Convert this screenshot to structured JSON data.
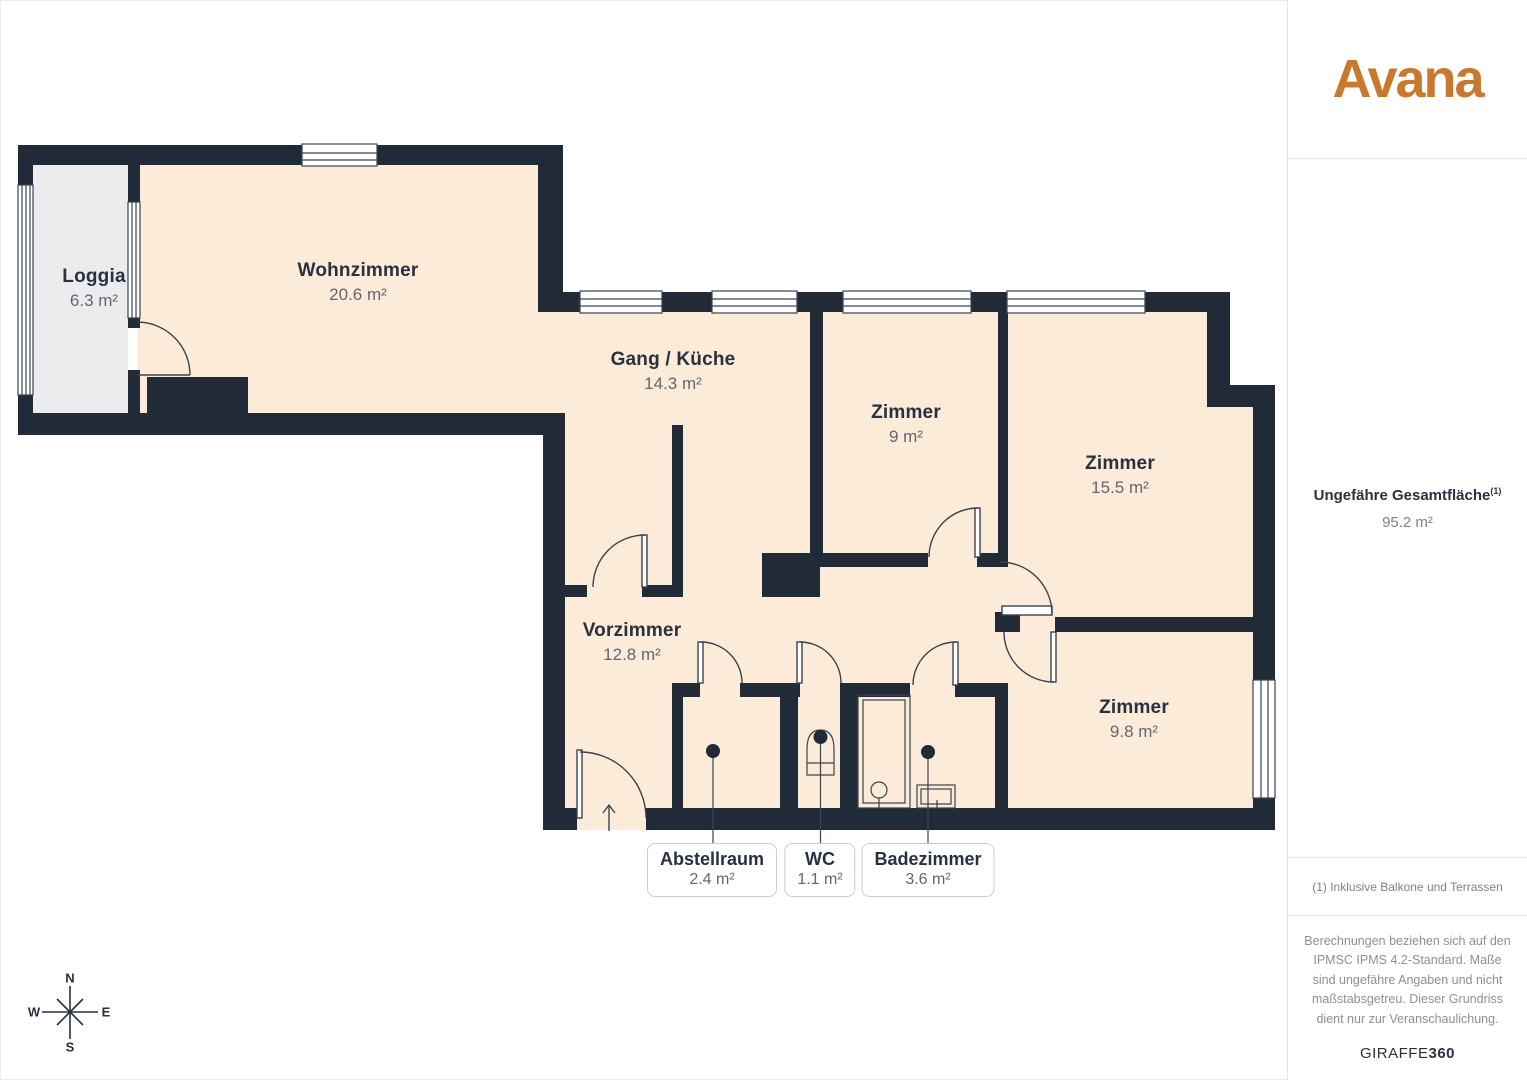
{
  "sidebar": {
    "brand": "Avana",
    "total_area_label": "Ungefähre Gesamtfläche",
    "total_area_superscript": "(1)",
    "total_area_value": "95.2 m²",
    "footnote": "(1) Inklusive Balkone und Terrassen",
    "disclaimer": "Berechnungen beziehen sich auf den IPMSC IPMS 4.2-Standard. Maße sind ungefähre Angaben und nicht maßstabsgetreu. Dieser Grundriss dient nur zur Veranschaulichung.",
    "watermark_regular": "GIRAFFE",
    "watermark_bold": "360"
  },
  "floorplan": {
    "rooms": [
      {
        "name": "Loggia",
        "area": "6.3 m²"
      },
      {
        "name": "Wohnzimmer",
        "area": "20.6 m²"
      },
      {
        "name": "Gang / Küche",
        "area": "14.3 m²"
      },
      {
        "name": "Zimmer",
        "area": "9 m²"
      },
      {
        "name": "Zimmer",
        "area": "15.5 m²"
      },
      {
        "name": "Vorzimmer",
        "area": "12.8 m²"
      },
      {
        "name": "Zimmer",
        "area": "9.8 m²"
      }
    ],
    "callouts": [
      {
        "name": "Abstellraum",
        "area": "2.4 m²"
      },
      {
        "name": "WC",
        "area": "1.1 m²"
      },
      {
        "name": "Badezimmer",
        "area": "3.6 m²"
      }
    ],
    "compass": {
      "north": "N",
      "south": "S",
      "east": "E",
      "west": "W"
    }
  },
  "colors": {
    "wall": "#212b38",
    "floor": "#fcebd8",
    "loggia": "#ececee",
    "line": "#3a4350",
    "ink": "#273140",
    "muted": "#5f6873",
    "accent": "#c8792e",
    "divider": "#e4e4e6",
    "box-border": "#c9ced5",
    "gray-text": "#7b828c"
  }
}
